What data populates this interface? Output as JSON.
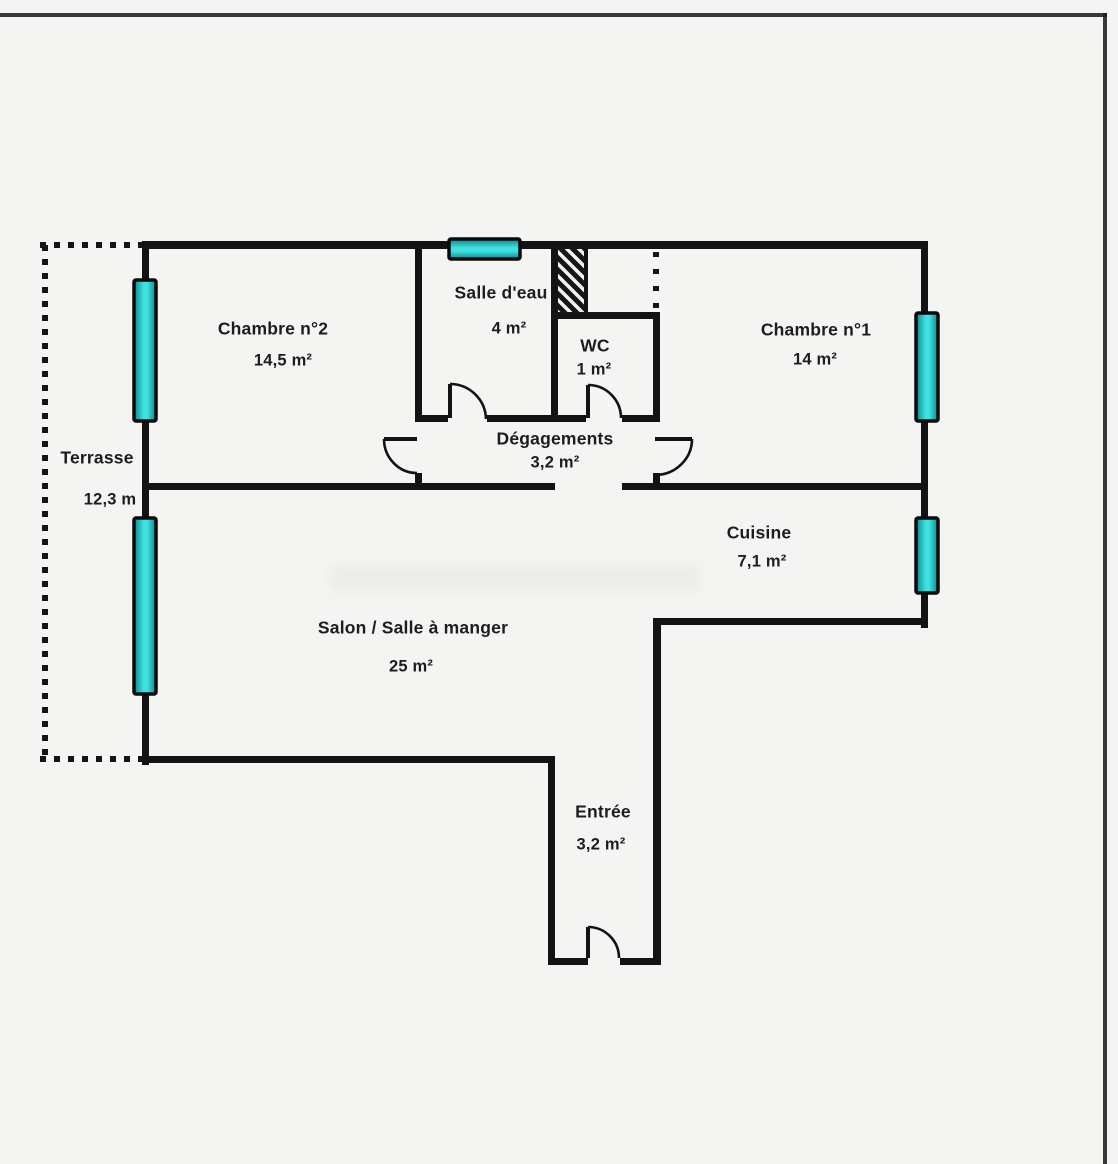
{
  "plan": {
    "type": "apartment-floor-plan",
    "rooms": {
      "chambre2": {
        "name": "Chambre n°2",
        "area": "14,5 m²"
      },
      "salle_deau": {
        "name": "Salle d'eau",
        "area": "4 m²"
      },
      "wc": {
        "name": "WC",
        "area": "1 m²"
      },
      "chambre1": {
        "name": "Chambre n°1",
        "area": "14 m²"
      },
      "degagements": {
        "name": "Dégagements",
        "area": "3,2 m²"
      },
      "cuisine": {
        "name": "Cuisine",
        "area": "7,1 m²"
      },
      "salon": {
        "name": "Salon / Salle à manger",
        "area": "25 m²"
      },
      "entree": {
        "name": "Entrée",
        "area": "3,2 m²"
      },
      "terrasse": {
        "name": "Terrasse",
        "area": "12,3 m"
      }
    },
    "features": {
      "window_markers": 5,
      "door_swings": 5,
      "hatched_duct": 1,
      "terrace_outline": "dotted"
    },
    "colors": {
      "wall": "#131313",
      "window_teal": "#3fe2e0",
      "window_teal_dark": "#0d858b",
      "background": "#f4f4f2",
      "text": "#1d1d1d"
    }
  }
}
